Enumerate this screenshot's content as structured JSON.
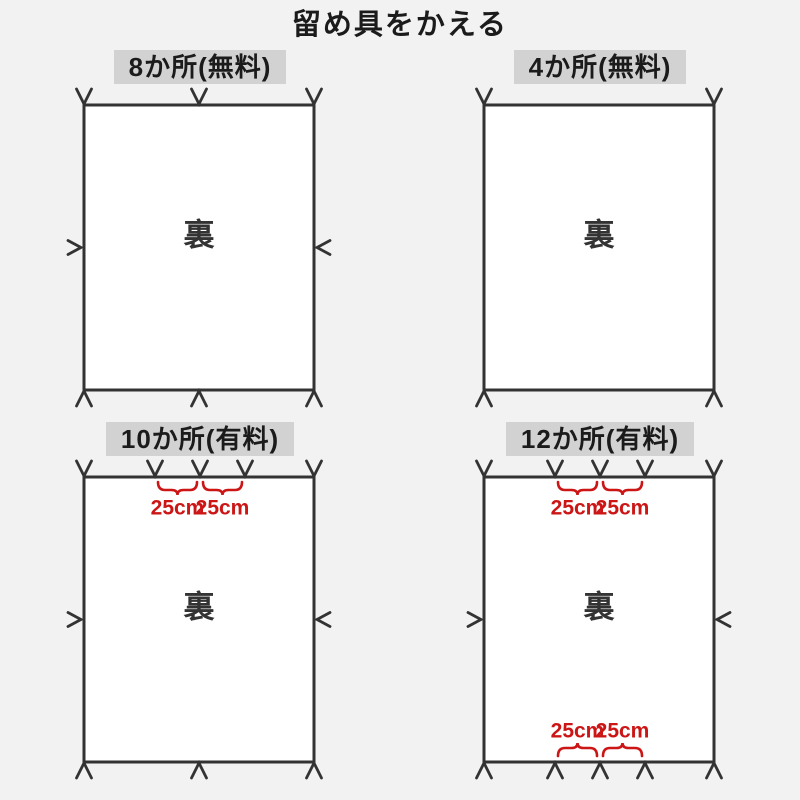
{
  "title": "留め具をかえる",
  "back_side_label": "裏",
  "measure_label": "25cm",
  "colors": {
    "background": "#f2f2f2",
    "ink": "#333333",
    "tick": "#3d3d3d",
    "tick_light": "#8b8b8b",
    "accent_red": "#cc1616",
    "label_background": "#d2d2d2",
    "sheet_fill": "#ffffff"
  },
  "panels": [
    {
      "name": "panel-8-places-free",
      "label": "8か所(無料)",
      "fastener_count": 8,
      "top_fastener_offsets": [
        0,
        115,
        230
      ],
      "bottom_fastener_offsets": [
        0,
        115,
        230
      ],
      "side_fasteners": true,
      "top_measures": false,
      "bottom_measures": false
    },
    {
      "name": "panel-4-places-free",
      "label": "4か所(無料)",
      "fastener_count": 4,
      "top_fastener_offsets": [
        0,
        230
      ],
      "bottom_fastener_offsets": [
        0,
        230
      ],
      "side_fasteners": false,
      "top_measures": false,
      "bottom_measures": false
    },
    {
      "name": "panel-10-places-paid",
      "label": "10か所(有料)",
      "fastener_count": 10,
      "top_fastener_offsets": [
        0,
        71,
        116,
        161,
        230
      ],
      "bottom_fastener_offsets": [
        0,
        115,
        230
      ],
      "side_fasteners": true,
      "top_measures": true,
      "bottom_measures": false
    },
    {
      "name": "panel-12-places-paid",
      "label": "12か所(有料)",
      "fastener_count": 12,
      "top_fastener_offsets": [
        0,
        71,
        116,
        161,
        230
      ],
      "bottom_fastener_offsets": [
        0,
        71,
        116,
        161,
        230
      ],
      "side_fasteners": true,
      "top_measures": true,
      "bottom_measures": true
    }
  ]
}
